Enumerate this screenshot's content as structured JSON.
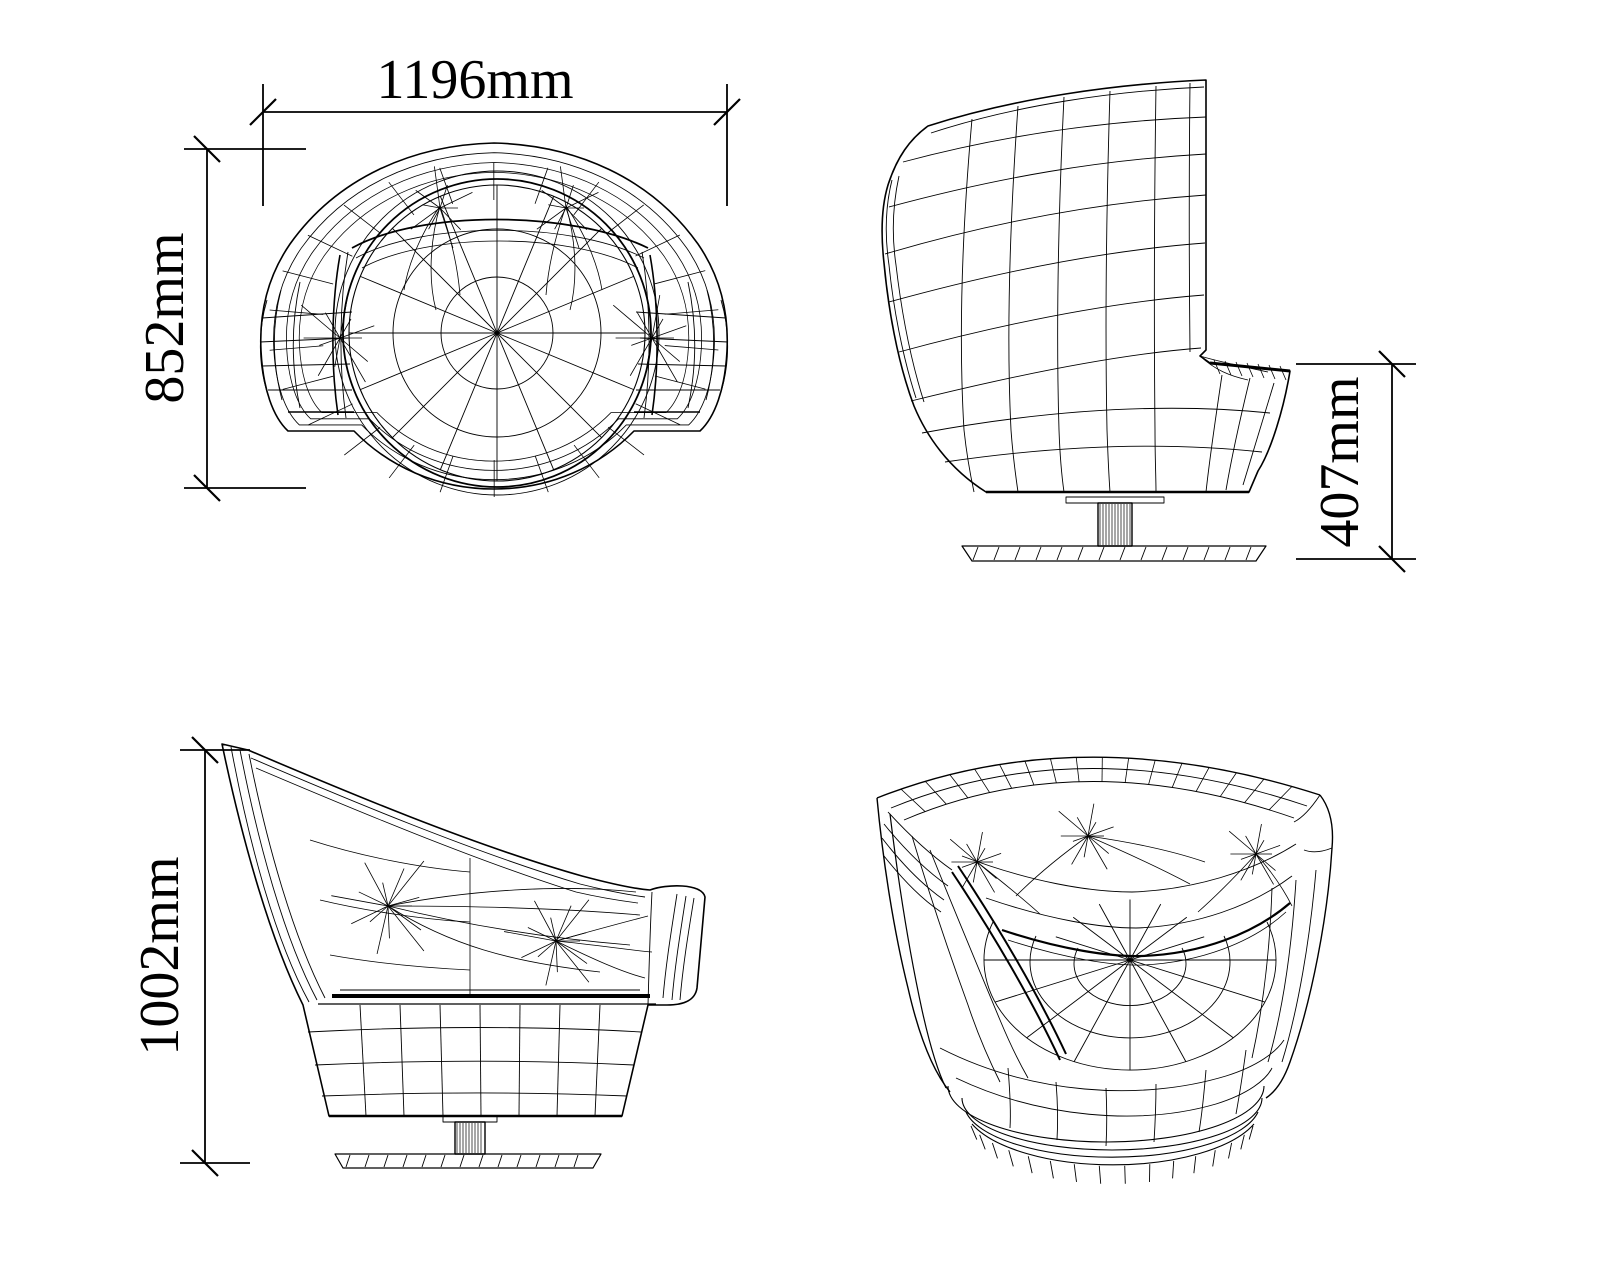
{
  "drawing": {
    "line_color": "#000000",
    "background_color": "#ffffff",
    "views": [
      "top-plan",
      "side-elevation-right",
      "side-elevation-left",
      "perspective"
    ]
  },
  "dimensions": {
    "overall_width": {
      "label": "1196mm",
      "value_mm": 1196
    },
    "overall_depth": {
      "label": "852mm",
      "value_mm": 852
    },
    "seat_height": {
      "label": "407mm",
      "value_mm": 407
    },
    "overall_height": {
      "label": "1002mm",
      "value_mm": 1002
    }
  }
}
